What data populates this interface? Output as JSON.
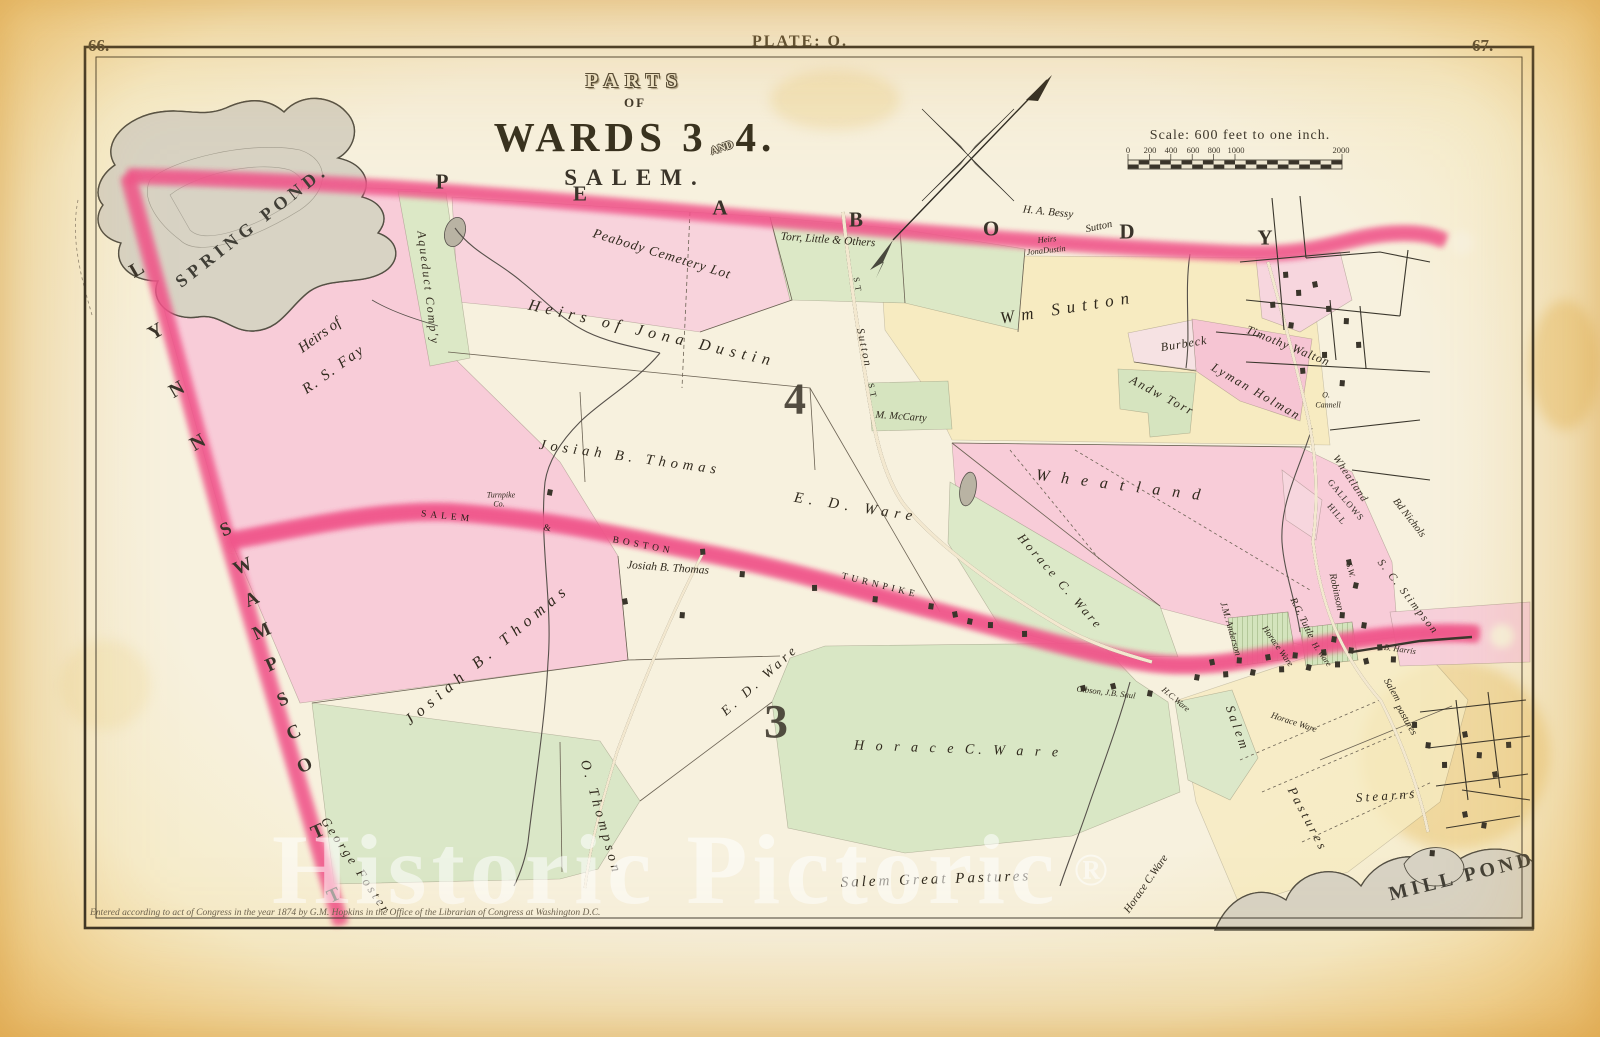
{
  "page": {
    "left_page_number": "66.",
    "right_page_number": "67.",
    "plate_label": "PLATE: O.",
    "copyright": "Entered according to act of Congress in the year 1874 by G.M. Hopkins in the Office of the Librarian of Congress at Washington D.C."
  },
  "title": {
    "parts": "PARTS",
    "of": "OF",
    "wards_left": "WARDS 3",
    "and": "AND",
    "wards_right": "4.",
    "city": "SALEM."
  },
  "scale": {
    "caption": "Scale: 600 feet to one inch."
  },
  "watermark": {
    "text": "Historic Pictoric",
    "registered": "®"
  },
  "colors": {
    "paper": "#f7f1de",
    "margin_amber": "#ecc178",
    "boundary_red": "#e31049",
    "pink_area": "#f7cbd7",
    "green_area": "#d9e6c4",
    "yellow_area": "#f7eabb",
    "water_gray": "#d8d3c4",
    "ink": "#2f2a20"
  },
  "map_labels": [
    {
      "t": "P",
      "x": 442,
      "y": 182,
      "s": 21,
      "r": 0,
      "c": "terr"
    },
    {
      "t": "E",
      "x": 580,
      "y": 194,
      "s": 21,
      "r": 0,
      "c": "terr"
    },
    {
      "t": "A",
      "x": 720,
      "y": 208,
      "s": 21,
      "r": 0,
      "c": "terr"
    },
    {
      "t": "B",
      "x": 856,
      "y": 220,
      "s": 21,
      "r": 0,
      "c": "terr"
    },
    {
      "t": "O",
      "x": 991,
      "y": 229,
      "s": 21,
      "r": 0,
      "c": "terr"
    },
    {
      "t": "D",
      "x": 1127,
      "y": 232,
      "s": 21,
      "r": 0,
      "c": "terr"
    },
    {
      "t": "Y",
      "x": 1265,
      "y": 238,
      "s": 21,
      "r": 0,
      "c": "terr"
    },
    {
      "t": "L",
      "x": 137,
      "y": 270,
      "s": 20,
      "r": -30,
      "c": "terr"
    },
    {
      "t": "Y",
      "x": 156,
      "y": 332,
      "s": 20,
      "r": -30,
      "c": "terr"
    },
    {
      "t": "N",
      "x": 177,
      "y": 390,
      "s": 20,
      "r": -30,
      "c": "terr"
    },
    {
      "t": "N",
      "x": 198,
      "y": 443,
      "s": 20,
      "r": -30,
      "c": "terr"
    },
    {
      "t": "S",
      "x": 226,
      "y": 530,
      "s": 19,
      "r": -24,
      "c": "terr"
    },
    {
      "t": "W",
      "x": 243,
      "y": 567,
      "s": 19,
      "r": -24,
      "c": "terr"
    },
    {
      "t": "A",
      "x": 252,
      "y": 600,
      "s": 19,
      "r": -24,
      "c": "terr"
    },
    {
      "t": "M",
      "x": 262,
      "y": 632,
      "s": 19,
      "r": -24,
      "c": "terr"
    },
    {
      "t": "P",
      "x": 272,
      "y": 665,
      "s": 19,
      "r": -24,
      "c": "terr"
    },
    {
      "t": "S",
      "x": 283,
      "y": 700,
      "s": 19,
      "r": -24,
      "c": "terr"
    },
    {
      "t": "C",
      "x": 294,
      "y": 733,
      "s": 19,
      "r": -24,
      "c": "terr"
    },
    {
      "t": "O",
      "x": 305,
      "y": 766,
      "s": 19,
      "r": -24,
      "c": "terr"
    },
    {
      "t": "T",
      "x": 318,
      "y": 832,
      "s": 19,
      "r": -24,
      "c": "terr"
    },
    {
      "t": "T",
      "x": 334,
      "y": 896,
      "s": 19,
      "r": -24,
      "c": "terr"
    },
    {
      "t": "SPRING  POND.",
      "x": 252,
      "y": 226,
      "s": 18,
      "r": -38,
      "c": "pond",
      "ls": 5
    },
    {
      "t": "Heirs of",
      "x": 320,
      "y": 336,
      "s": 15,
      "r": -36,
      "c": "n"
    },
    {
      "t": "R. S. Fay",
      "x": 334,
      "y": 370,
      "s": 15,
      "r": -36,
      "c": "n",
      "ls": 2
    },
    {
      "t": "Aqueduct Comp'y",
      "x": 428,
      "y": 288,
      "s": 12,
      "r": 83,
      "c": "n",
      "ls": 2
    },
    {
      "t": "Heirs of Jona Dustin",
      "x": 652,
      "y": 334,
      "s": 16,
      "r": 13,
      "c": "n",
      "ls": 6
    },
    {
      "t": "Peabody Cemetery Lot",
      "x": 662,
      "y": 254,
      "s": 13.5,
      "r": 17,
      "c": "n",
      "ls": 1
    },
    {
      "t": "Torr, Little & Others",
      "x": 828,
      "y": 240,
      "s": 11.5,
      "r": 4,
      "c": "n"
    },
    {
      "t": "H. A. Bessy",
      "x": 1048,
      "y": 212,
      "s": 11,
      "r": 6,
      "c": "n"
    },
    {
      "t": "Sutton",
      "x": 1099,
      "y": 227,
      "s": 10.5,
      "r": -12,
      "c": "n"
    },
    {
      "t": "Heirs",
      "x": 1047,
      "y": 239,
      "s": 8.5,
      "r": -6,
      "c": "n"
    },
    {
      "t": "JonaDustin",
      "x": 1046,
      "y": 250,
      "s": 8.5,
      "r": -6,
      "c": "n"
    },
    {
      "t": "Wm  Sutton",
      "x": 1068,
      "y": 308,
      "s": 17,
      "r": -9,
      "c": "n",
      "ls": 7
    },
    {
      "t": "ST",
      "x": 858,
      "y": 286,
      "s": 8.5,
      "r": 80,
      "c": "road"
    },
    {
      "t": "Sutton",
      "x": 864,
      "y": 348,
      "s": 11,
      "r": 78,
      "c": "n",
      "ls": 2
    },
    {
      "t": "ST",
      "x": 873,
      "y": 392,
      "s": 8.5,
      "r": 78,
      "c": "road"
    },
    {
      "t": "Burbeck",
      "x": 1184,
      "y": 344,
      "s": 12,
      "r": -9,
      "c": "n",
      "ls": 1
    },
    {
      "t": "Timothy Walton",
      "x": 1288,
      "y": 346,
      "s": 12,
      "r": 22,
      "c": "n",
      "ls": 1
    },
    {
      "t": "Andw Torr",
      "x": 1162,
      "y": 396,
      "s": 12.5,
      "r": 28,
      "c": "n",
      "ls": 2
    },
    {
      "t": "Lyman Holman",
      "x": 1256,
      "y": 392,
      "s": 12.5,
      "r": 30,
      "c": "n",
      "ls": 2
    },
    {
      "t": "O.",
      "x": 1326,
      "y": 395,
      "s": 8,
      "r": 0,
      "c": "n"
    },
    {
      "t": "Cannell",
      "x": 1328,
      "y": 405,
      "s": 8,
      "r": 0,
      "c": "n"
    },
    {
      "t": "M. McCarty",
      "x": 901,
      "y": 417,
      "s": 10.5,
      "r": 4,
      "c": "n"
    },
    {
      "t": "4",
      "x": 795,
      "y": 399,
      "s": 44,
      "r": 0,
      "c": "ward"
    },
    {
      "t": "3",
      "x": 776,
      "y": 722,
      "s": 48,
      "r": 0,
      "c": "ward"
    },
    {
      "t": "Josiah  B.  Thomas",
      "x": 630,
      "y": 458,
      "s": 14.5,
      "r": 8,
      "c": "n",
      "ls": 5
    },
    {
      "t": "Turnpike",
      "x": 501,
      "y": 495,
      "s": 8,
      "r": 0,
      "c": "n"
    },
    {
      "t": "Co.",
      "x": 499,
      "y": 504,
      "s": 8,
      "r": 0,
      "c": "n"
    },
    {
      "t": "SALEM",
      "x": 447,
      "y": 517,
      "s": 9.5,
      "r": 6,
      "c": "road"
    },
    {
      "t": "&",
      "x": 549,
      "y": 529,
      "s": 9.5,
      "r": 8,
      "c": "road"
    },
    {
      "t": "BOSTON",
      "x": 643,
      "y": 546,
      "s": 9.5,
      "r": 11,
      "c": "road"
    },
    {
      "t": "TURNPIKE",
      "x": 880,
      "y": 586,
      "s": 9.5,
      "r": 14,
      "c": "road"
    },
    {
      "t": "E.  D.  Ware",
      "x": 856,
      "y": 508,
      "s": 15,
      "r": 9,
      "c": "n",
      "ls": 6
    },
    {
      "t": "E. D. Ware",
      "x": 760,
      "y": 680,
      "s": 13.5,
      "r": -42,
      "c": "n",
      "ls": 4
    },
    {
      "t": "Josiah B. Thomas",
      "x": 668,
      "y": 568,
      "s": 11.5,
      "r": 4,
      "c": "n"
    },
    {
      "t": "Josiah  B.  Thomas",
      "x": 488,
      "y": 655,
      "s": 16,
      "r": -40,
      "c": "n",
      "ls": 6
    },
    {
      "t": "O. Thompson",
      "x": 600,
      "y": 818,
      "s": 14,
      "r": 74,
      "c": "n",
      "ls": 4
    },
    {
      "t": "George Foster",
      "x": 356,
      "y": 866,
      "s": 13,
      "r": 56,
      "c": "n",
      "ls": 3
    },
    {
      "t": "Horace  C. Ware",
      "x": 1060,
      "y": 582,
      "s": 12.5,
      "r": 49,
      "c": "n",
      "ls": 3
    },
    {
      "t": "W h e a t l a n d",
      "x": 1120,
      "y": 486,
      "s": 16,
      "r": 7,
      "c": "n",
      "ls": 4
    },
    {
      "t": "Wheatland",
      "x": 1350,
      "y": 479,
      "s": 10.5,
      "r": 56,
      "c": "n",
      "ls": 1
    },
    {
      "t": "GALLOWS",
      "x": 1346,
      "y": 500,
      "s": 9,
      "r": 50,
      "c": "caps"
    },
    {
      "t": "HILL",
      "x": 1337,
      "y": 514,
      "s": 9,
      "r": 50,
      "c": "caps"
    },
    {
      "t": "Robinson",
      "x": 1336,
      "y": 592,
      "s": 10,
      "r": 78,
      "c": "n"
    },
    {
      "t": "S.W.",
      "x": 1351,
      "y": 570,
      "s": 8.5,
      "r": 75,
      "c": "n"
    },
    {
      "t": "S. C. Stimpson",
      "x": 1408,
      "y": 597,
      "s": 11,
      "r": 52,
      "c": "n",
      "ls": 2
    },
    {
      "t": "Bd  Nichols",
      "x": 1409,
      "y": 518,
      "s": 10.5,
      "r": 52,
      "c": "n"
    },
    {
      "t": "R.G. Tuttle",
      "x": 1302,
      "y": 618,
      "s": 10,
      "r": 64,
      "c": "n"
    },
    {
      "t": "J.M. Anderson",
      "x": 1230,
      "y": 629,
      "s": 9.5,
      "r": 74,
      "c": "n"
    },
    {
      "t": "Horace Ware",
      "x": 1278,
      "y": 646,
      "s": 9,
      "r": 55,
      "c": "n"
    },
    {
      "t": "H. Ware",
      "x": 1322,
      "y": 654,
      "s": 8.5,
      "r": 55,
      "c": "n"
    },
    {
      "t": "Horace Ware",
      "x": 1294,
      "y": 722,
      "s": 9,
      "r": 18,
      "c": "n"
    },
    {
      "t": "B. Harris",
      "x": 1400,
      "y": 649,
      "s": 8.5,
      "r": 8,
      "c": "n"
    },
    {
      "t": "Gibson,  J.B. Saul",
      "x": 1106,
      "y": 692,
      "s": 8.5,
      "r": 7,
      "c": "n"
    },
    {
      "t": "H.C.Ware",
      "x": 1176,
      "y": 699,
      "s": 8.5,
      "r": 40,
      "c": "n"
    },
    {
      "t": "S a l e m",
      "x": 1237,
      "y": 727,
      "s": 13,
      "r": 70,
      "c": "n"
    },
    {
      "t": "P a s t u r e s",
      "x": 1307,
      "y": 818,
      "s": 13,
      "r": 62,
      "c": "n"
    },
    {
      "t": "Salem",
      "x": 1392,
      "y": 690,
      "s": 10,
      "r": 60,
      "c": "n"
    },
    {
      "t": "pastures",
      "x": 1406,
      "y": 720,
      "s": 10,
      "r": 60,
      "c": "n"
    },
    {
      "t": "S t e a r n s",
      "x": 1385,
      "y": 796,
      "s": 13,
      "r": -4,
      "c": "n"
    },
    {
      "t": "MILL POND",
      "x": 1462,
      "y": 877,
      "s": 20,
      "r": -14,
      "c": "pond",
      "ls": 4
    },
    {
      "t": "Salem   Great   Pastures",
      "x": 936,
      "y": 880,
      "s": 15,
      "r": -2,
      "c": "n",
      "ls": 3
    },
    {
      "t": "Horace C.Ware",
      "x": 1146,
      "y": 884,
      "s": 11,
      "r": -55,
      "c": "n"
    },
    {
      "t": "H o r a c e   C.   W a r e",
      "x": 958,
      "y": 750,
      "s": 14,
      "r": 2,
      "c": "n",
      "ls": 4
    },
    {
      "t": "0",
      "x": 1128,
      "y": 150,
      "s": 8.5,
      "r": 0,
      "c": "tick"
    },
    {
      "t": "200",
      "x": 1150,
      "y": 150,
      "s": 8.5,
      "r": 0,
      "c": "tick"
    },
    {
      "t": "400",
      "x": 1171,
      "y": 150,
      "s": 8.5,
      "r": 0,
      "c": "tick"
    },
    {
      "t": "600",
      "x": 1193,
      "y": 150,
      "s": 8.5,
      "r": 0,
      "c": "tick"
    },
    {
      "t": "800",
      "x": 1214,
      "y": 150,
      "s": 8.5,
      "r": 0,
      "c": "tick"
    },
    {
      "t": "1000",
      "x": 1236,
      "y": 150,
      "s": 8.5,
      "r": 0,
      "c": "tick"
    },
    {
      "t": "2000",
      "x": 1341,
      "y": 150,
      "s": 8.5,
      "r": 0,
      "c": "tick"
    }
  ]
}
